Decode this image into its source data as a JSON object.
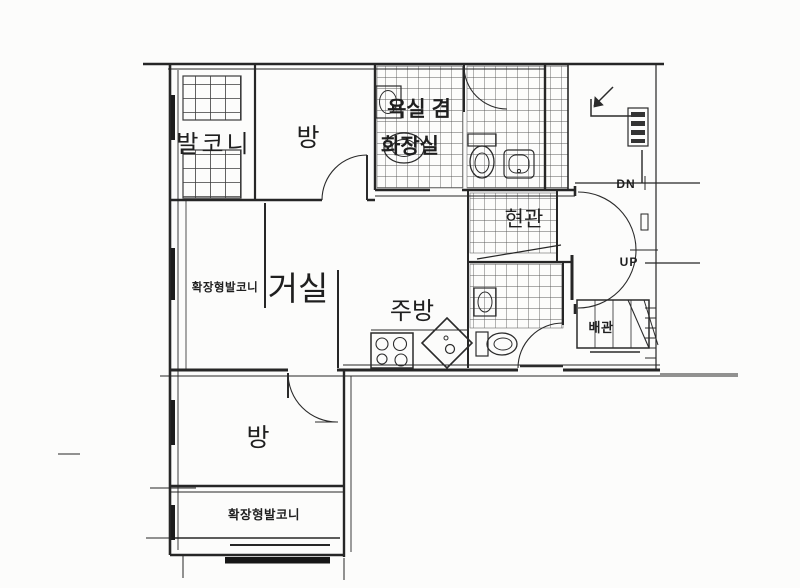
{
  "document": {
    "type": "apartment-floor-plan-scan"
  },
  "colors": {
    "ink": "#262626",
    "paper": "#fcfcfb",
    "tile_line": "#5a5a5a",
    "window_grid_line": "#3c3c3c",
    "dark_bar": "#161616"
  },
  "rooms": {
    "balcony_top": {
      "label": "발코니"
    },
    "bedroom_top": {
      "label": "방"
    },
    "bathroom": {
      "label_line1": "욕실 겸",
      "label_line2": "화장실"
    },
    "entrance": {
      "label": "현관"
    },
    "living_room": {
      "label": "거실"
    },
    "extended_balcony_left": {
      "label": "확장형발코니"
    },
    "kitchen": {
      "label": "주방"
    },
    "pipe_shaft": {
      "label": "배관"
    },
    "bedroom_bottom": {
      "label": "방"
    },
    "extended_balcony_bottom": {
      "label": "확장형발코니"
    }
  },
  "stairs": {
    "down_label": "DN",
    "up_label": "UP"
  },
  "icons": [
    "stove-icon",
    "kitchen-sink-icon",
    "toilet-icon",
    "toilet-icon-2",
    "washbasin-icon",
    "washbasin-icon-2",
    "washing-machine-icon",
    "hand-sink-icon",
    "entry-direction-arrow-icon",
    "duct-icon",
    "stair-treads-icon"
  ]
}
